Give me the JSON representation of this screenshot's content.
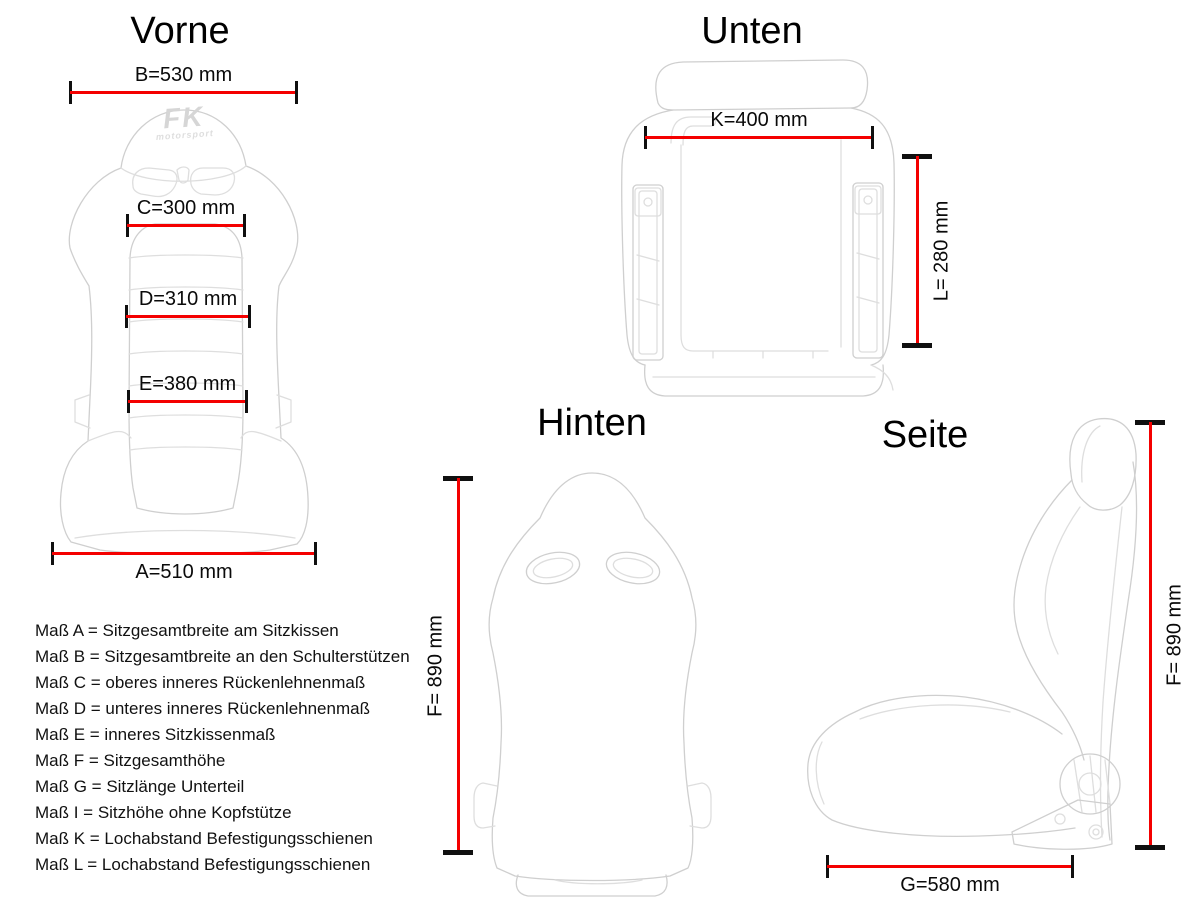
{
  "page": {
    "background": "#ffffff",
    "dimension_line_color": "#f40000",
    "tick_color": "#101010",
    "text_color": "#0a0a0a",
    "drawing_color": "#cfcfcf"
  },
  "views": {
    "vorne": {
      "title": "Vorne"
    },
    "unten": {
      "title": "Unten"
    },
    "hinten": {
      "title": "Hinten"
    },
    "seite": {
      "title": "Seite"
    }
  },
  "logo": {
    "brand": "FK",
    "sub": "motorsport"
  },
  "dimensions": {
    "A": {
      "label": "A=510 mm",
      "value_mm": 510,
      "view": "Vorne",
      "orientation": "horizontal"
    },
    "B": {
      "label": "B=530 mm",
      "value_mm": 530,
      "view": "Vorne",
      "orientation": "horizontal"
    },
    "C": {
      "label": "C=300 mm",
      "value_mm": 300,
      "view": "Vorne",
      "orientation": "horizontal"
    },
    "D": {
      "label": "D=310 mm",
      "value_mm": 310,
      "view": "Vorne",
      "orientation": "horizontal"
    },
    "E": {
      "label": "E=380 mm",
      "value_mm": 380,
      "view": "Vorne",
      "orientation": "horizontal"
    },
    "K": {
      "label": "K=400 mm",
      "value_mm": 400,
      "view": "Unten",
      "orientation": "horizontal"
    },
    "L": {
      "label": "L= 280 mm",
      "value_mm": 280,
      "view": "Unten",
      "orientation": "vertical"
    },
    "F_hinten": {
      "label": "F= 890 mm",
      "value_mm": 890,
      "view": "Hinten",
      "orientation": "vertical"
    },
    "F_seite": {
      "label": "F= 890 mm",
      "value_mm": 890,
      "view": "Seite",
      "orientation": "vertical"
    },
    "G": {
      "label": "G=580 mm",
      "value_mm": 580,
      "view": "Seite",
      "orientation": "horizontal"
    }
  },
  "legend": {
    "items": [
      "Maß A = Sitzgesamtbreite am Sitzkissen",
      "Maß B = Sitzgesamtbreite an den Schulterstützen",
      "Maß C = oberes inneres Rückenlehnenmaß",
      "Maß D = unteres inneres Rückenlehnenmaß",
      "Maß E = inneres Sitzkissenmaß",
      "Maß F = Sitzgesamthöhe",
      "Maß G = Sitzlänge Unterteil",
      "Maß I = Sitzhöhe ohne Kopfstütze",
      "Maß K = Lochabstand Befestigungsschienen",
      "Maß L = Lochabstand Befestigungsschienen"
    ]
  }
}
